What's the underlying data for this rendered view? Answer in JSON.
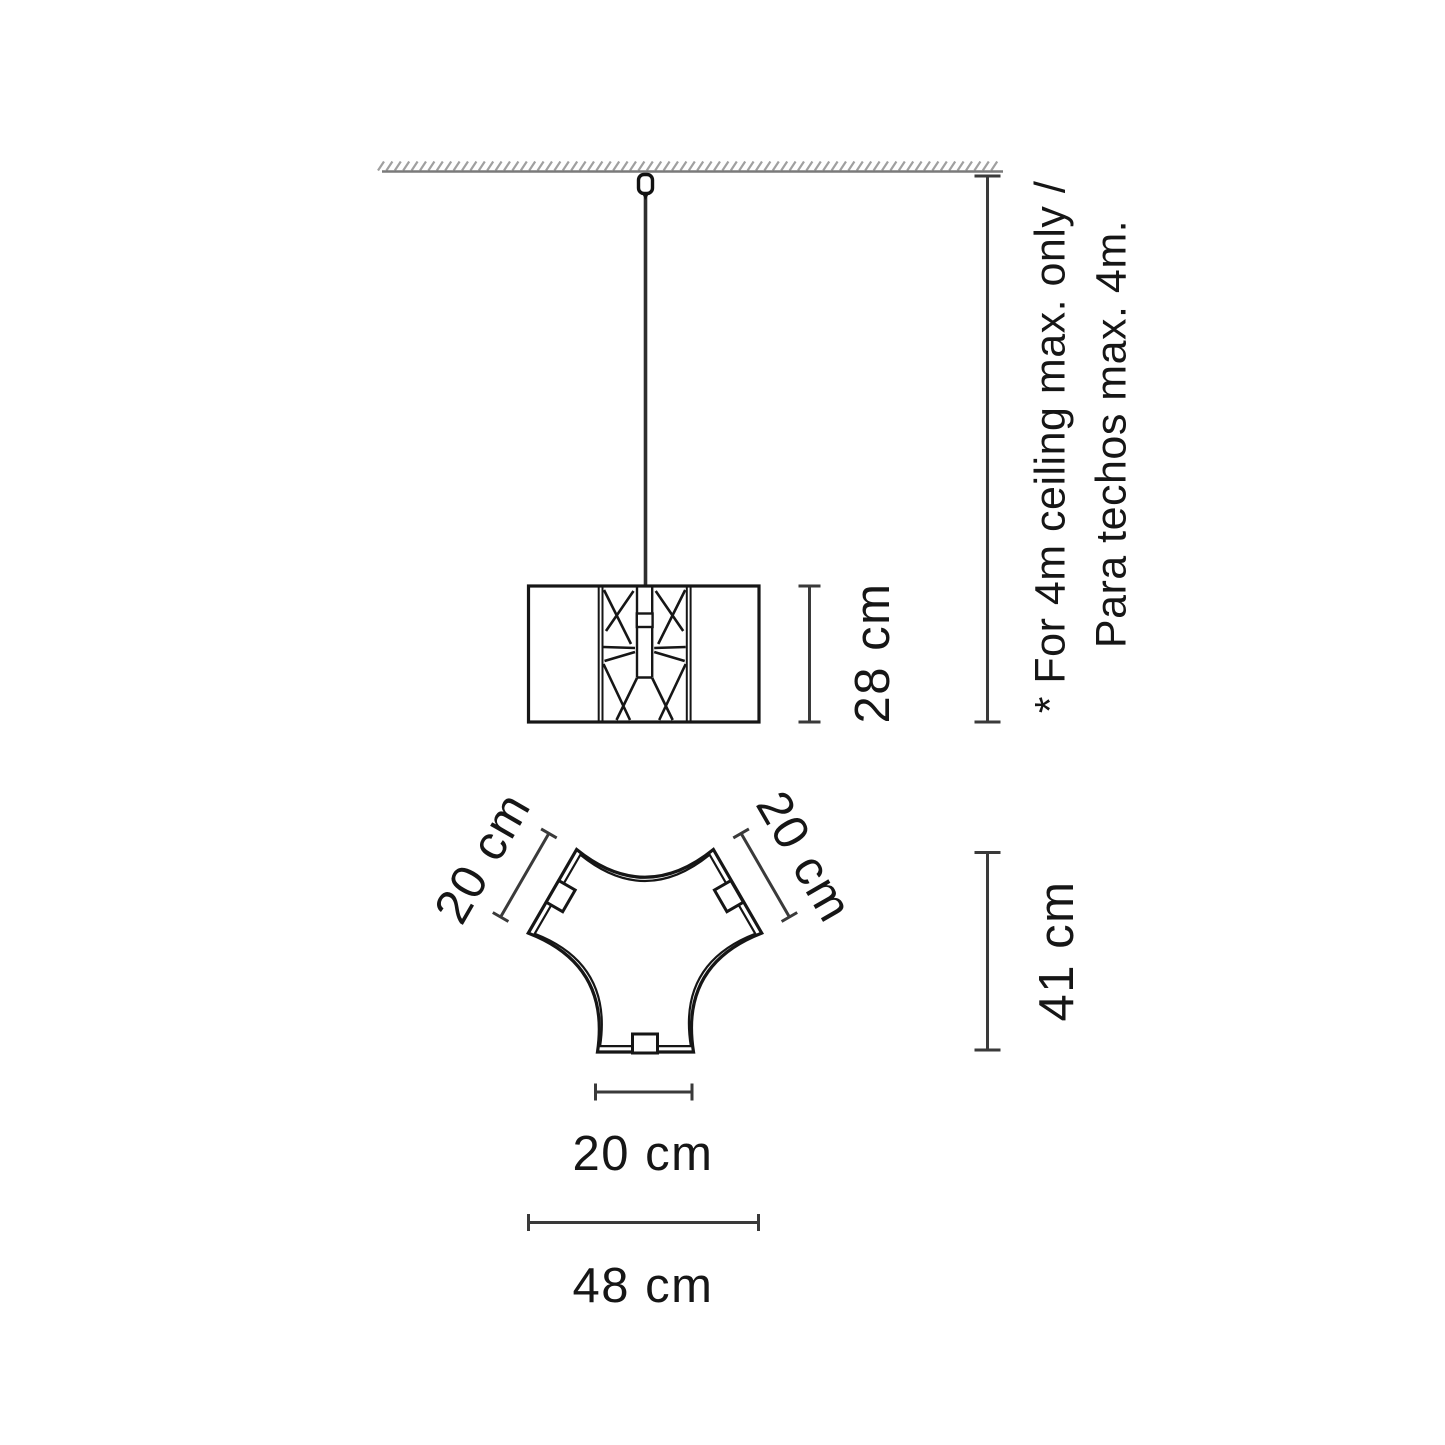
{
  "notes": {
    "ceiling_note_en": "* For 4m ceiling max. only /",
    "ceiling_note_es": "Para techos max. 4m."
  },
  "dimensions": {
    "shade_height": "28 cm",
    "top_view_height": "41 cm",
    "top_left_edge": "20 cm",
    "top_right_edge": "20 cm",
    "bottom_edge": "20 cm",
    "overall_width": "48 cm"
  },
  "colors": {
    "drawing_line": "#161616",
    "dimension_line": "#3a3a3a",
    "ceiling_line": "#7a7a7a",
    "hatch": "#a0a0a0",
    "background": "#ffffff"
  }
}
